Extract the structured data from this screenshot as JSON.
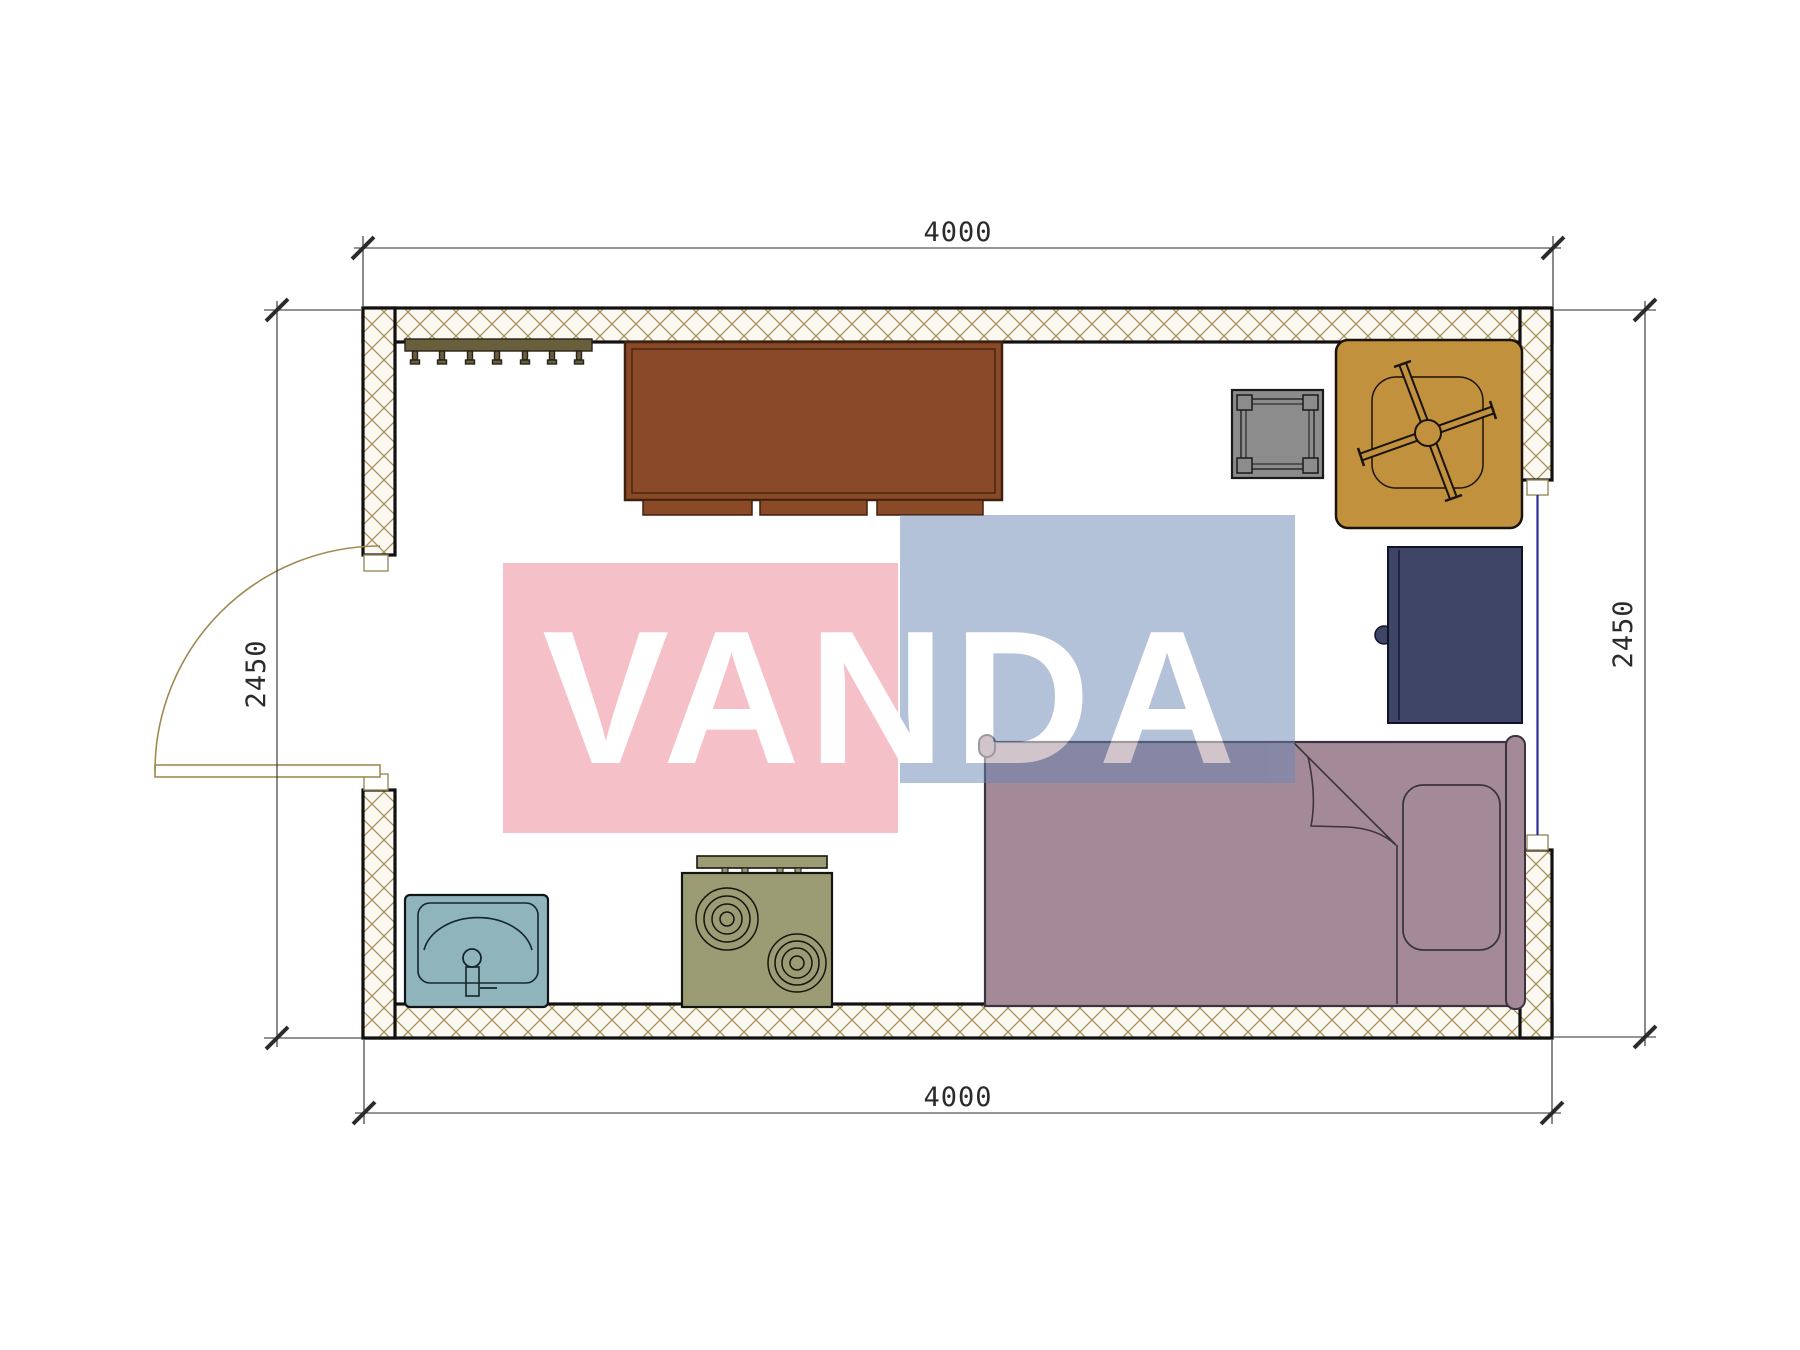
{
  "dimensions": {
    "top": "4000",
    "bottom": "4000",
    "left": "2450",
    "right": "2450"
  },
  "watermark": {
    "text": "VANDA",
    "pink": "#ee8295",
    "blue": "#6a86b4",
    "text_color": "#ffffff"
  },
  "colors": {
    "floor": "#ffffff",
    "wall_hatch_line": "#a89058",
    "wall_hatch_bg": "#fbf8f2",
    "wall_outline": "#111111",
    "dimension": "#2b2b2b",
    "door": "#a08a52",
    "window": "#2d2d9e",
    "coat_rack": "#6a5f3c",
    "wardrobe": "#8a4a28",
    "wardrobe_outline": "#40200e",
    "stool": "#8c8c8c",
    "armchair": "#c1913e",
    "nightstand": "#3e4565",
    "bed": "#a48a97",
    "bed_outline": "#3a3340",
    "sink": "#90b4bc",
    "stove": "#9b9c74"
  },
  "furniture_items": [
    "coat-rack",
    "wardrobe-cabinet",
    "stool",
    "swivel-armchair",
    "nightstand",
    "single-bed",
    "pillow",
    "sink",
    "two-burner-stove"
  ],
  "openings": [
    "door-bottom-left",
    "window-right"
  ]
}
